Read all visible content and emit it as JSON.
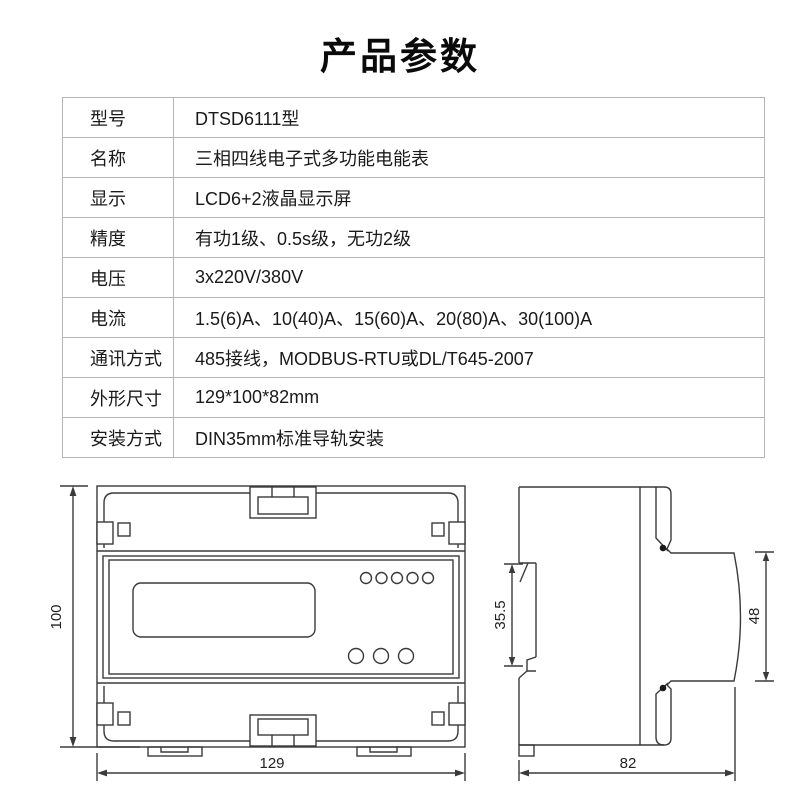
{
  "page": {
    "title": "产品参数"
  },
  "spec_table": {
    "rows": [
      {
        "label": "型号",
        "value": "DTSD6111型"
      },
      {
        "label": "名称",
        "value": "三相四线电子式多功能电能表"
      },
      {
        "label": "显示",
        "value": "LCD6+2液晶显示屏"
      },
      {
        "label": "精度",
        "value": "有功1级、0.5s级，无功2级"
      },
      {
        "label": "电压",
        "value": "3x220V/380V"
      },
      {
        "label": "电流",
        "value": "1.5(6)A、10(40)A、15(60)A、20(80)A、30(100)A"
      },
      {
        "label": "通讯方式",
        "value": "485接线，MODBUS-RTU或DL/T645-2007"
      },
      {
        "label": "外形尺寸",
        "value": "129*100*82mm"
      },
      {
        "label": "安装方式",
        "value": "DIN35mm标准导轨安装"
      }
    ]
  },
  "drawings": {
    "front_view": {
      "height_mm": "100",
      "width_mm": "129"
    },
    "side_view": {
      "rail_notch_mm": "35.5",
      "face_height_mm": "48",
      "depth_mm": "82"
    }
  },
  "colors": {
    "line": "#3a3a3a",
    "table_border": "#b5b5b5",
    "text": "#1a1a1a",
    "background": "#ffffff"
  }
}
